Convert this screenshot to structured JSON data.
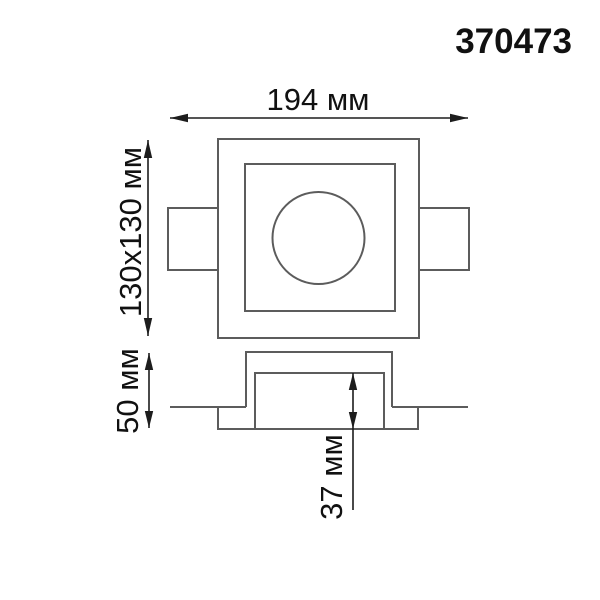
{
  "product_code": "370473",
  "dimensions": {
    "overall_width_label": "194 мм",
    "face_size_label": "130x130 мм",
    "height_label": "50 мм",
    "recess_depth_label": "37 мм"
  },
  "colors": {
    "background": "#ffffff",
    "outline": "#5c5c5c",
    "dimension": "#1d1d1d",
    "text": "#111111"
  }
}
